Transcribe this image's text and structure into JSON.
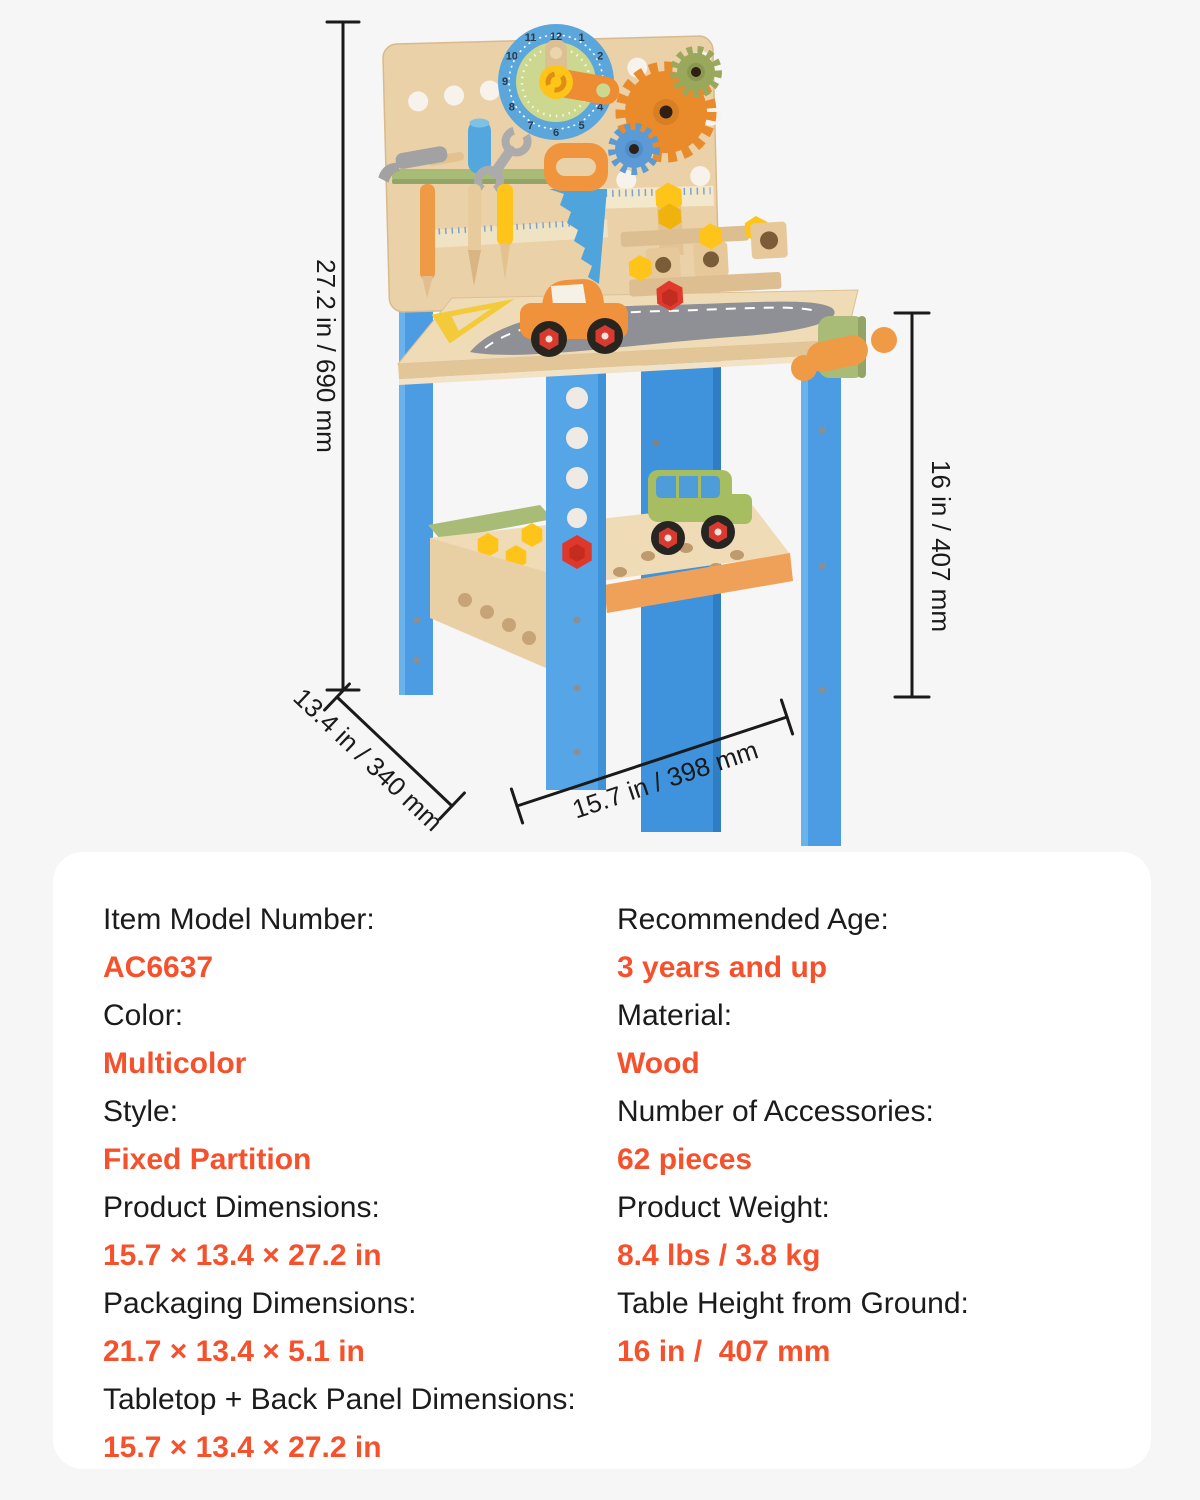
{
  "page": {
    "background": "#F6F6F6",
    "card_background": "#FFFFFF",
    "accent_color": "#F4512C",
    "text_color": "#1B1B1B"
  },
  "annotations": {
    "height": "27.2 in / 690 mm",
    "depth": "13.4 in / 340 mm",
    "width": "15.7 in / 398 mm",
    "table_height": "16 in / 407 mm"
  },
  "illustration": {
    "clock_numbers": [
      "12",
      "1",
      "2",
      "3",
      "4",
      "5",
      "6",
      "7",
      "8",
      "9",
      "10",
      "11"
    ]
  },
  "specs": {
    "left": [
      {
        "label": "Item Model Number:",
        "value": "AC6637"
      },
      {
        "label": "Color:",
        "value": "Multicolor"
      },
      {
        "label": "Style:",
        "value": "Fixed Partition"
      },
      {
        "label": "Product Dimensions:",
        "value": "15.7 × 13.4 × 27.2 in"
      },
      {
        "label": "Packaging Dimensions:",
        "value": "21.7 × 13.4 × 5.1 in"
      },
      {
        "label": "Tabletop + Back Panel Dimensions:",
        "value": "15.7 × 13.4 × 27.2 in"
      }
    ],
    "right": [
      {
        "label": "Recommended Age:",
        "value": "3 years and up"
      },
      {
        "label": "Material:",
        "value": "Wood"
      },
      {
        "label": "Number of Accessories:",
        "value": "62 pieces"
      },
      {
        "label": "Product Weight:",
        "value": "8.4 lbs / 3.8 kg"
      },
      {
        "label": "Table Height from Ground:",
        "value": "16 in /  407 mm"
      }
    ]
  }
}
